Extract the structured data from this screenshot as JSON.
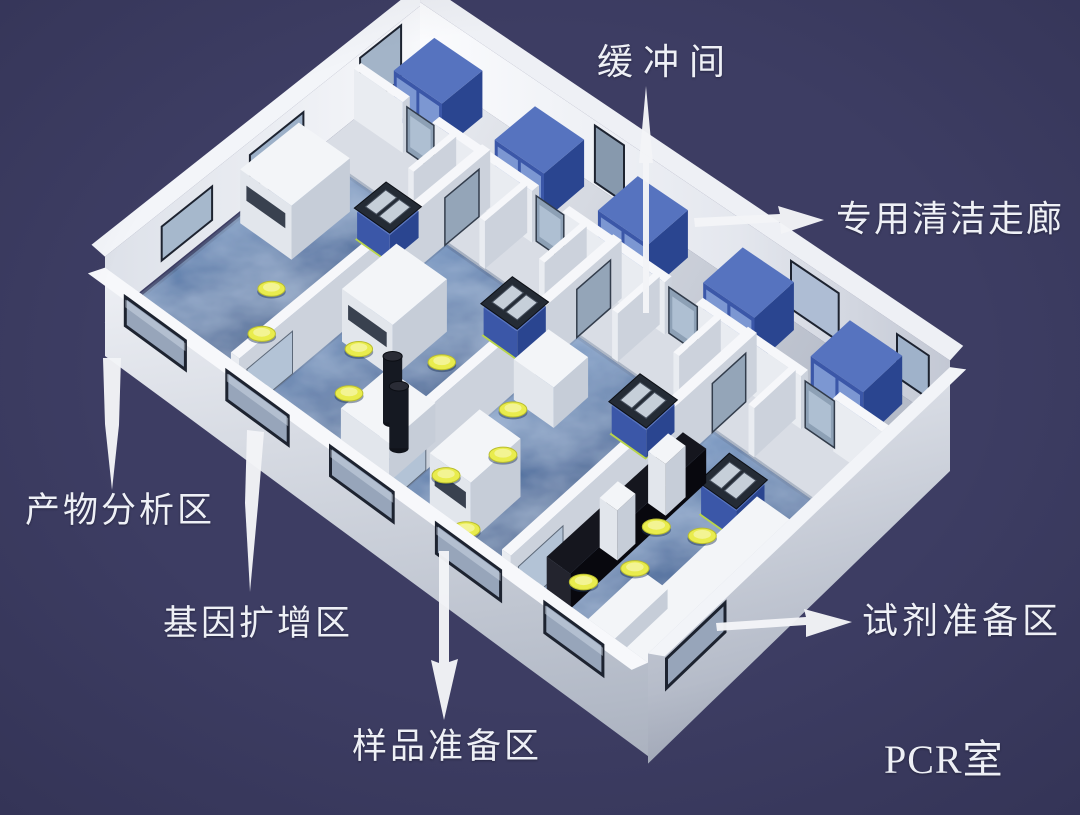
{
  "scene": {
    "type": "3d-isometric-cutaway-rendering",
    "subject": "PCR laboratory floor plan"
  },
  "labels": {
    "buffer_room": "缓冲间",
    "clean_corridor": "专用清洁走廊",
    "product_analysis": "产物分析区",
    "gene_amplification": "基因扩增区",
    "sample_preparation": "样品准备区",
    "reagent_preparation": "试剂准备区",
    "pcr_room": "PCR室"
  },
  "annotations": [
    {
      "target": "buffer_room",
      "style": "tapered-needle",
      "direction": "up-toward-label"
    },
    {
      "target": "product_analysis",
      "style": "tapered-needle",
      "direction": "down-toward-label"
    },
    {
      "target": "gene_amplification",
      "style": "tapered-needle",
      "direction": "down-toward-label"
    },
    {
      "target": "sample_preparation",
      "style": "barbed-arrow",
      "direction": "down-toward-label"
    },
    {
      "target": "reagent_preparation",
      "style": "barbed-arrow",
      "direction": "right-toward-label"
    },
    {
      "target": "clean_corridor",
      "style": "barbed-arrow",
      "direction": "right-toward-label"
    }
  ],
  "colors": {
    "background": "#3d3d63",
    "wall_white": "#f2f3f7",
    "wall_shade": "#c9cdd8",
    "corridor_floor": "#e9ebf1",
    "floor_blue": "#46699c",
    "floor_blue_light": "#7b9fcc",
    "floor_blue_dark": "#243f6b",
    "cabinet_blue": "#3b57a8",
    "cabinet_blue_light": "#5673bf",
    "cabinet_blue_dark": "#2a4590",
    "cabinet_door": "#7c97d2",
    "stool_yellow": "#e9ec4d",
    "glass": "#97a5ba",
    "frame_dark": "#1d2330",
    "bench_black": "#15161e",
    "arrow_white": "#f3f4f7",
    "label_text": "#eef0f6"
  }
}
